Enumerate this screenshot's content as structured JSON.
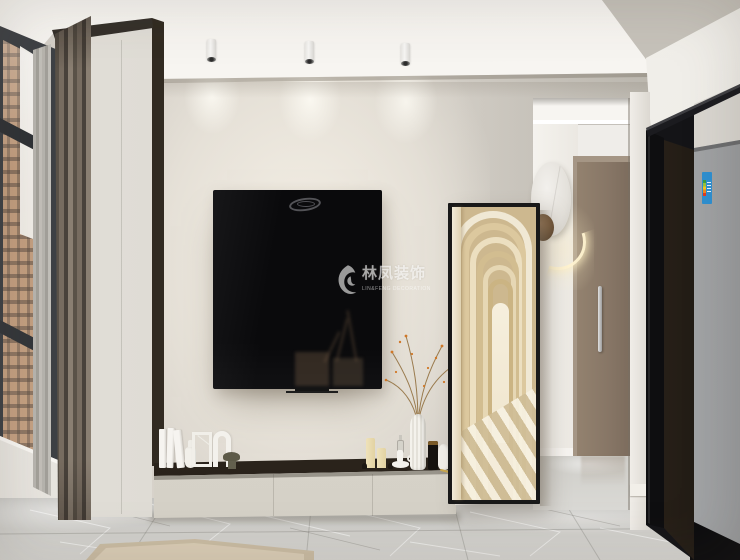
{
  "meta": {
    "type": "interior-design-render",
    "view": "living-room-tv-wall-with-hallway"
  },
  "watermark": {
    "title": "林凤装饰",
    "subtitle": "LIN&FENG DECORATION",
    "logo": "phoenix-swirl-logo",
    "color": "rgba(255,255,255,0.6)"
  },
  "palette": {
    "ceiling": "#f1efeb",
    "upper_wall": "#c9c4bc",
    "tv_wall": "#e9e4da",
    "cabinet_front": "#d8d4ca",
    "cabinet_top": "#3a3128",
    "curtain": "#6e6459",
    "window_frame": "#3e4145",
    "building": "#c59d7e",
    "floor_marble": "#cecdc9",
    "rug": "#dbceb7",
    "mirror_corridor": "#e8dcc2",
    "door": "#877666",
    "partition_glass": "#141417",
    "fridge": "#b4b6b8",
    "energy_label": "#2e8fd0",
    "lamp_glow": "#fff3d0",
    "wood_ball": "#6f5336"
  },
  "scene": {
    "objects": [
      "ceiling-spotlight",
      "ceiling-spotlight",
      "ceiling-spotlight",
      "window-city-view",
      "sheer-curtain",
      "blackout-curtain",
      "wall-mounted-tv",
      "tv-lowboard-cabinet",
      "white-books",
      "bottle-vase",
      "frame-sculpture",
      "arch-sculpture",
      "olive-bowl",
      "pillar-candle",
      "pillar-candle",
      "chamberstick-candle-holder",
      "sculpted-white-vase",
      "dried-branch-with-berries",
      "black-jar-candle",
      "bust-vase",
      "leaning-floor-mirror-arched-corridor-reflection",
      "marble-disc-wall-lamp",
      "wood-ball",
      "led-glow-ring",
      "hallway-opening",
      "interior-door",
      "door-handle",
      "black-framed-glass-partition",
      "refrigerator",
      "energy-efficiency-label",
      "marble-tile-floor",
      "beige-rug"
    ]
  }
}
